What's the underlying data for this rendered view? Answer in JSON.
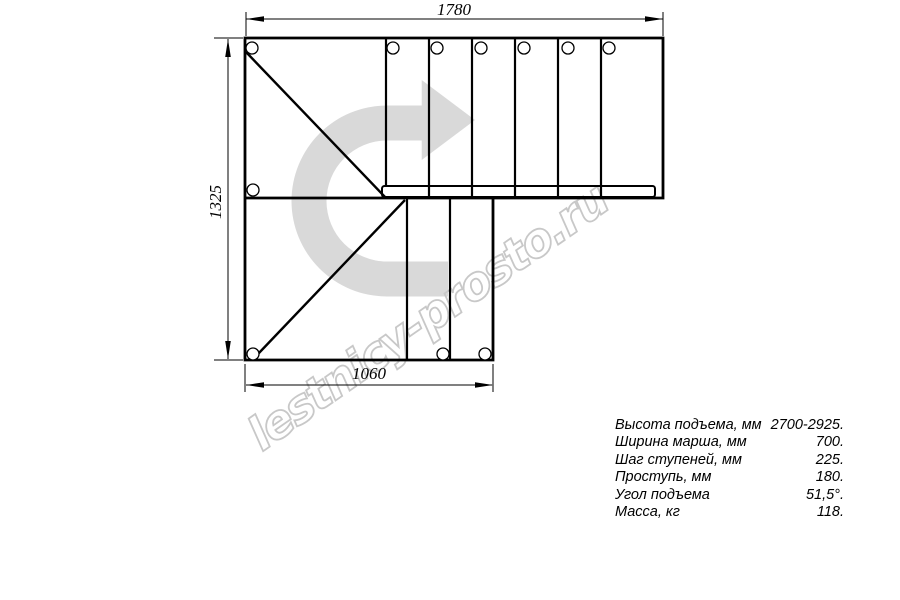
{
  "drawing": {
    "watermark": "lestnicy-prosto.ru",
    "dim_top": "1780",
    "dim_left": "1325",
    "dim_bottom": "1060"
  },
  "specs": {
    "rows": [
      {
        "label": "Высота подъема, мм",
        "value": "2700-2925."
      },
      {
        "label": "Ширина марша, мм",
        "value": "700."
      },
      {
        "label": "Шаг ступеней, мм",
        "value": "225."
      },
      {
        "label": "Проступь, мм",
        "value": "180."
      },
      {
        "label": "Угол подъема",
        "value": "51,5°."
      },
      {
        "label": "Масса, кг",
        "value": "118."
      }
    ]
  },
  "colors": {
    "line": "#000000",
    "arrow": "#d9d9d9",
    "watermark": "#c8c8c8",
    "background": "#ffffff"
  }
}
